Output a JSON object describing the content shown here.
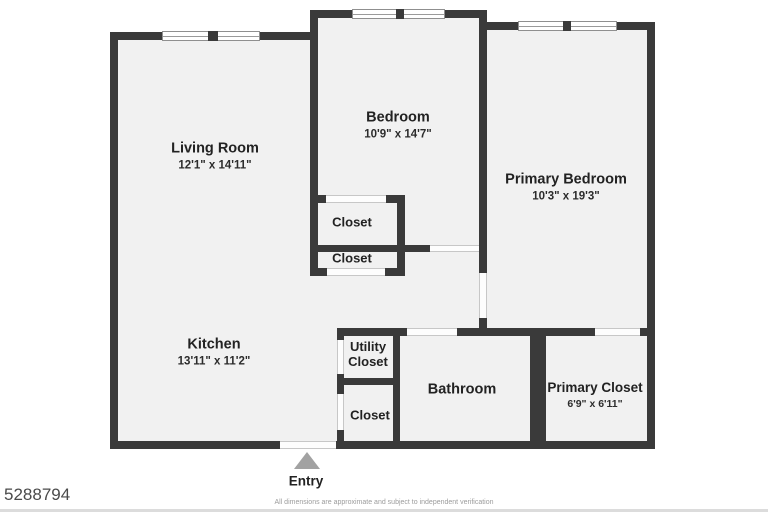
{
  "watermark": "5288794",
  "footer_text": "All dimensions are approximate and subject to independent verification",
  "entry": {
    "label": "Entry"
  },
  "rooms": {
    "living": {
      "name": "Living Room",
      "dims": "12'1\" x 14'11\""
    },
    "bedroom": {
      "name": "Bedroom",
      "dims": "10'9\" x 14'7\""
    },
    "primary": {
      "name": "Primary Bedroom",
      "dims": "10'3\" x 19'3\""
    },
    "kitchen": {
      "name": "Kitchen",
      "dims": "13'11\" x 11'2\""
    },
    "closet_upper": {
      "name": "Closet"
    },
    "closet_lower": {
      "name": "Closet"
    },
    "utility_closet": {
      "name": "Utility Closet"
    },
    "closet_bottom": {
      "name": "Closet"
    },
    "bathroom": {
      "name": "Bathroom"
    },
    "primary_closet": {
      "name": "Primary Closet",
      "dims": "6'9\" x 6'11\""
    }
  },
  "colors": {
    "wall": "#3a3a3a",
    "room_fill": "#f1f1f1",
    "entry_arrow": "#a2a2a2",
    "text": "#222222"
  }
}
